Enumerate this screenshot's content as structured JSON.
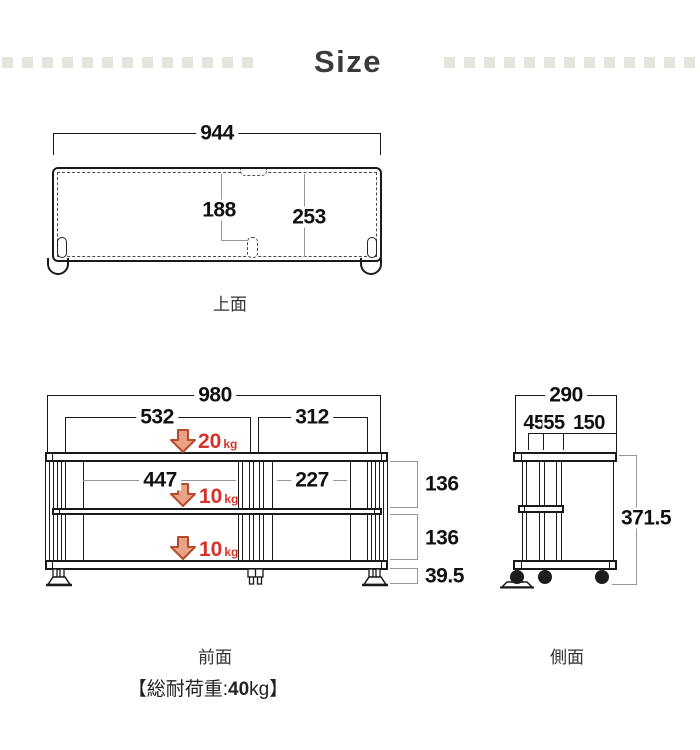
{
  "title": "Size",
  "colors": {
    "line": "#1a1a1a",
    "leader": "#979797",
    "accent_red": "#d5332a",
    "arrow_fill": "#e9a285",
    "arrow_stroke": "#b44b2c",
    "decor_square": "#e6e4df"
  },
  "top_view": {
    "label": "上面",
    "width": "944",
    "slot_offset": "188",
    "depth": "253"
  },
  "front_view": {
    "label": "前面",
    "overall_width": "980",
    "left_section_width": "532",
    "right_section_width": "312",
    "left_shelf_width": "447",
    "right_shelf_width": "227",
    "opening_height_top": "136",
    "opening_height_bottom": "136",
    "leg_height": "39.5",
    "loads": [
      {
        "value": "20",
        "unit": "kg"
      },
      {
        "value": "10",
        "unit": "kg"
      },
      {
        "value": "10",
        "unit": "kg"
      }
    ]
  },
  "side_view": {
    "label": "側面",
    "overall_depth": "290",
    "segment_1": "45",
    "segment_2": "55",
    "segment_3": "150",
    "height": "371.5"
  },
  "footer": {
    "total_load_prefix": "【総耐荷重:",
    "total_load_value": "40",
    "total_load_unit": "kg",
    "total_load_suffix": "】"
  }
}
